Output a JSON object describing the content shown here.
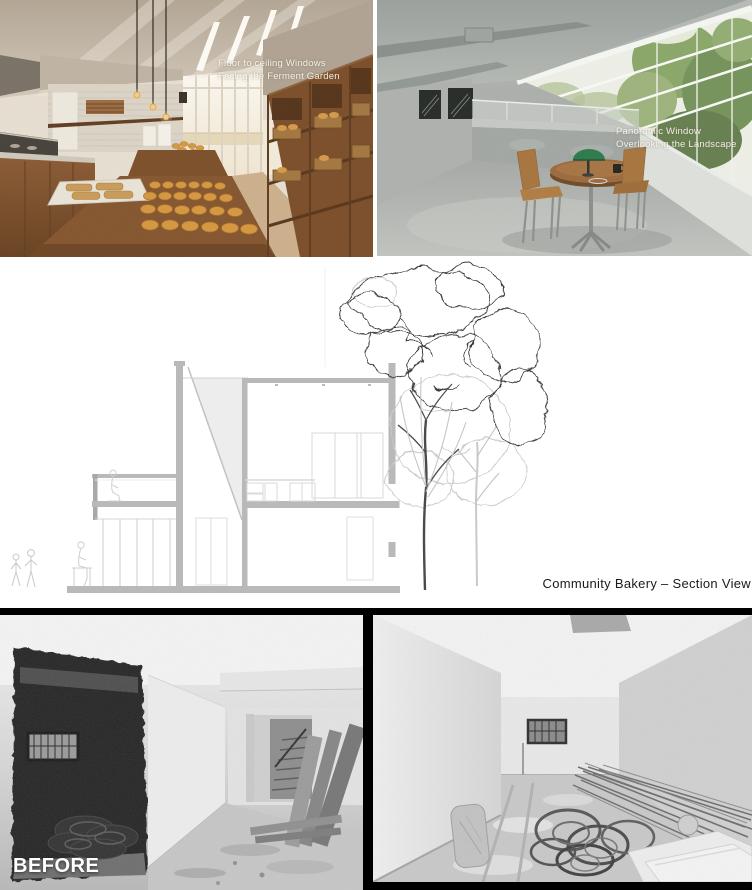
{
  "renders": {
    "bakery": {
      "annotation": {
        "line1": "Floor to ceiling Windows",
        "line2": "Facing the Ferment Garden"
      }
    },
    "seating": {
      "annotation": {
        "line1": "Panoramic Window",
        "line2": "Overlooking the Landscape"
      }
    }
  },
  "section": {
    "label": "Community Bakery – Section View"
  },
  "before": {
    "label": "BEFORE"
  },
  "colors": {
    "page_background": "#ffffff",
    "bottom_band": "#000000",
    "annotation_text": "#faf8f2",
    "section_label_text": "#1a1a1a",
    "drawing_wall_gray": "#b9b9b9",
    "tree_ink": "#3d3d3d",
    "wood_brown": "#8a5a33",
    "bread_gold": "#d6973f",
    "lamp_green": "#2c7a4a",
    "concrete_gray": "#a9adab"
  }
}
